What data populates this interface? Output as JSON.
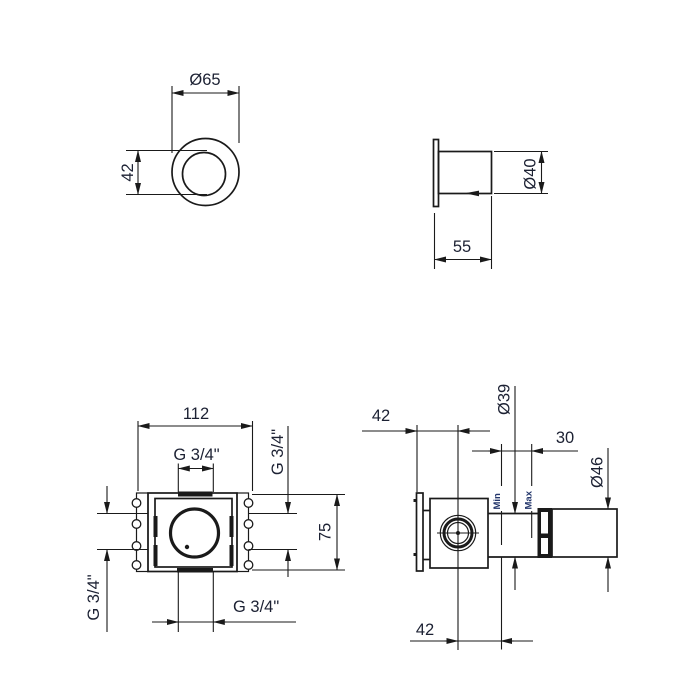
{
  "colors": {
    "line": "#1a1a1a",
    "dimension_text": "#1c2133",
    "minmax_text": "#23366b",
    "background": "#ffffff"
  },
  "views": {
    "handle_front": {
      "dims": {
        "diameter": "Ø65",
        "knob": "42"
      }
    },
    "handle_side": {
      "dims": {
        "diameter": "Ø40",
        "depth": "55"
      }
    },
    "valve_front": {
      "dims": {
        "width": "112",
        "height": "75",
        "thread_top": "G 3/4\"",
        "thread_bottom": "G 3/4\"",
        "thread_left": "G 3/4\"",
        "thread_right": "G 3/4\""
      }
    },
    "valve_side": {
      "dims": {
        "wall_to_axis": "42",
        "spindle_diameter": "Ø39",
        "adjustment_range": "30",
        "trim_diameter": "Ø46",
        "axis_to_min": "42",
        "min_label": "Min",
        "max_label": "Max"
      }
    }
  }
}
